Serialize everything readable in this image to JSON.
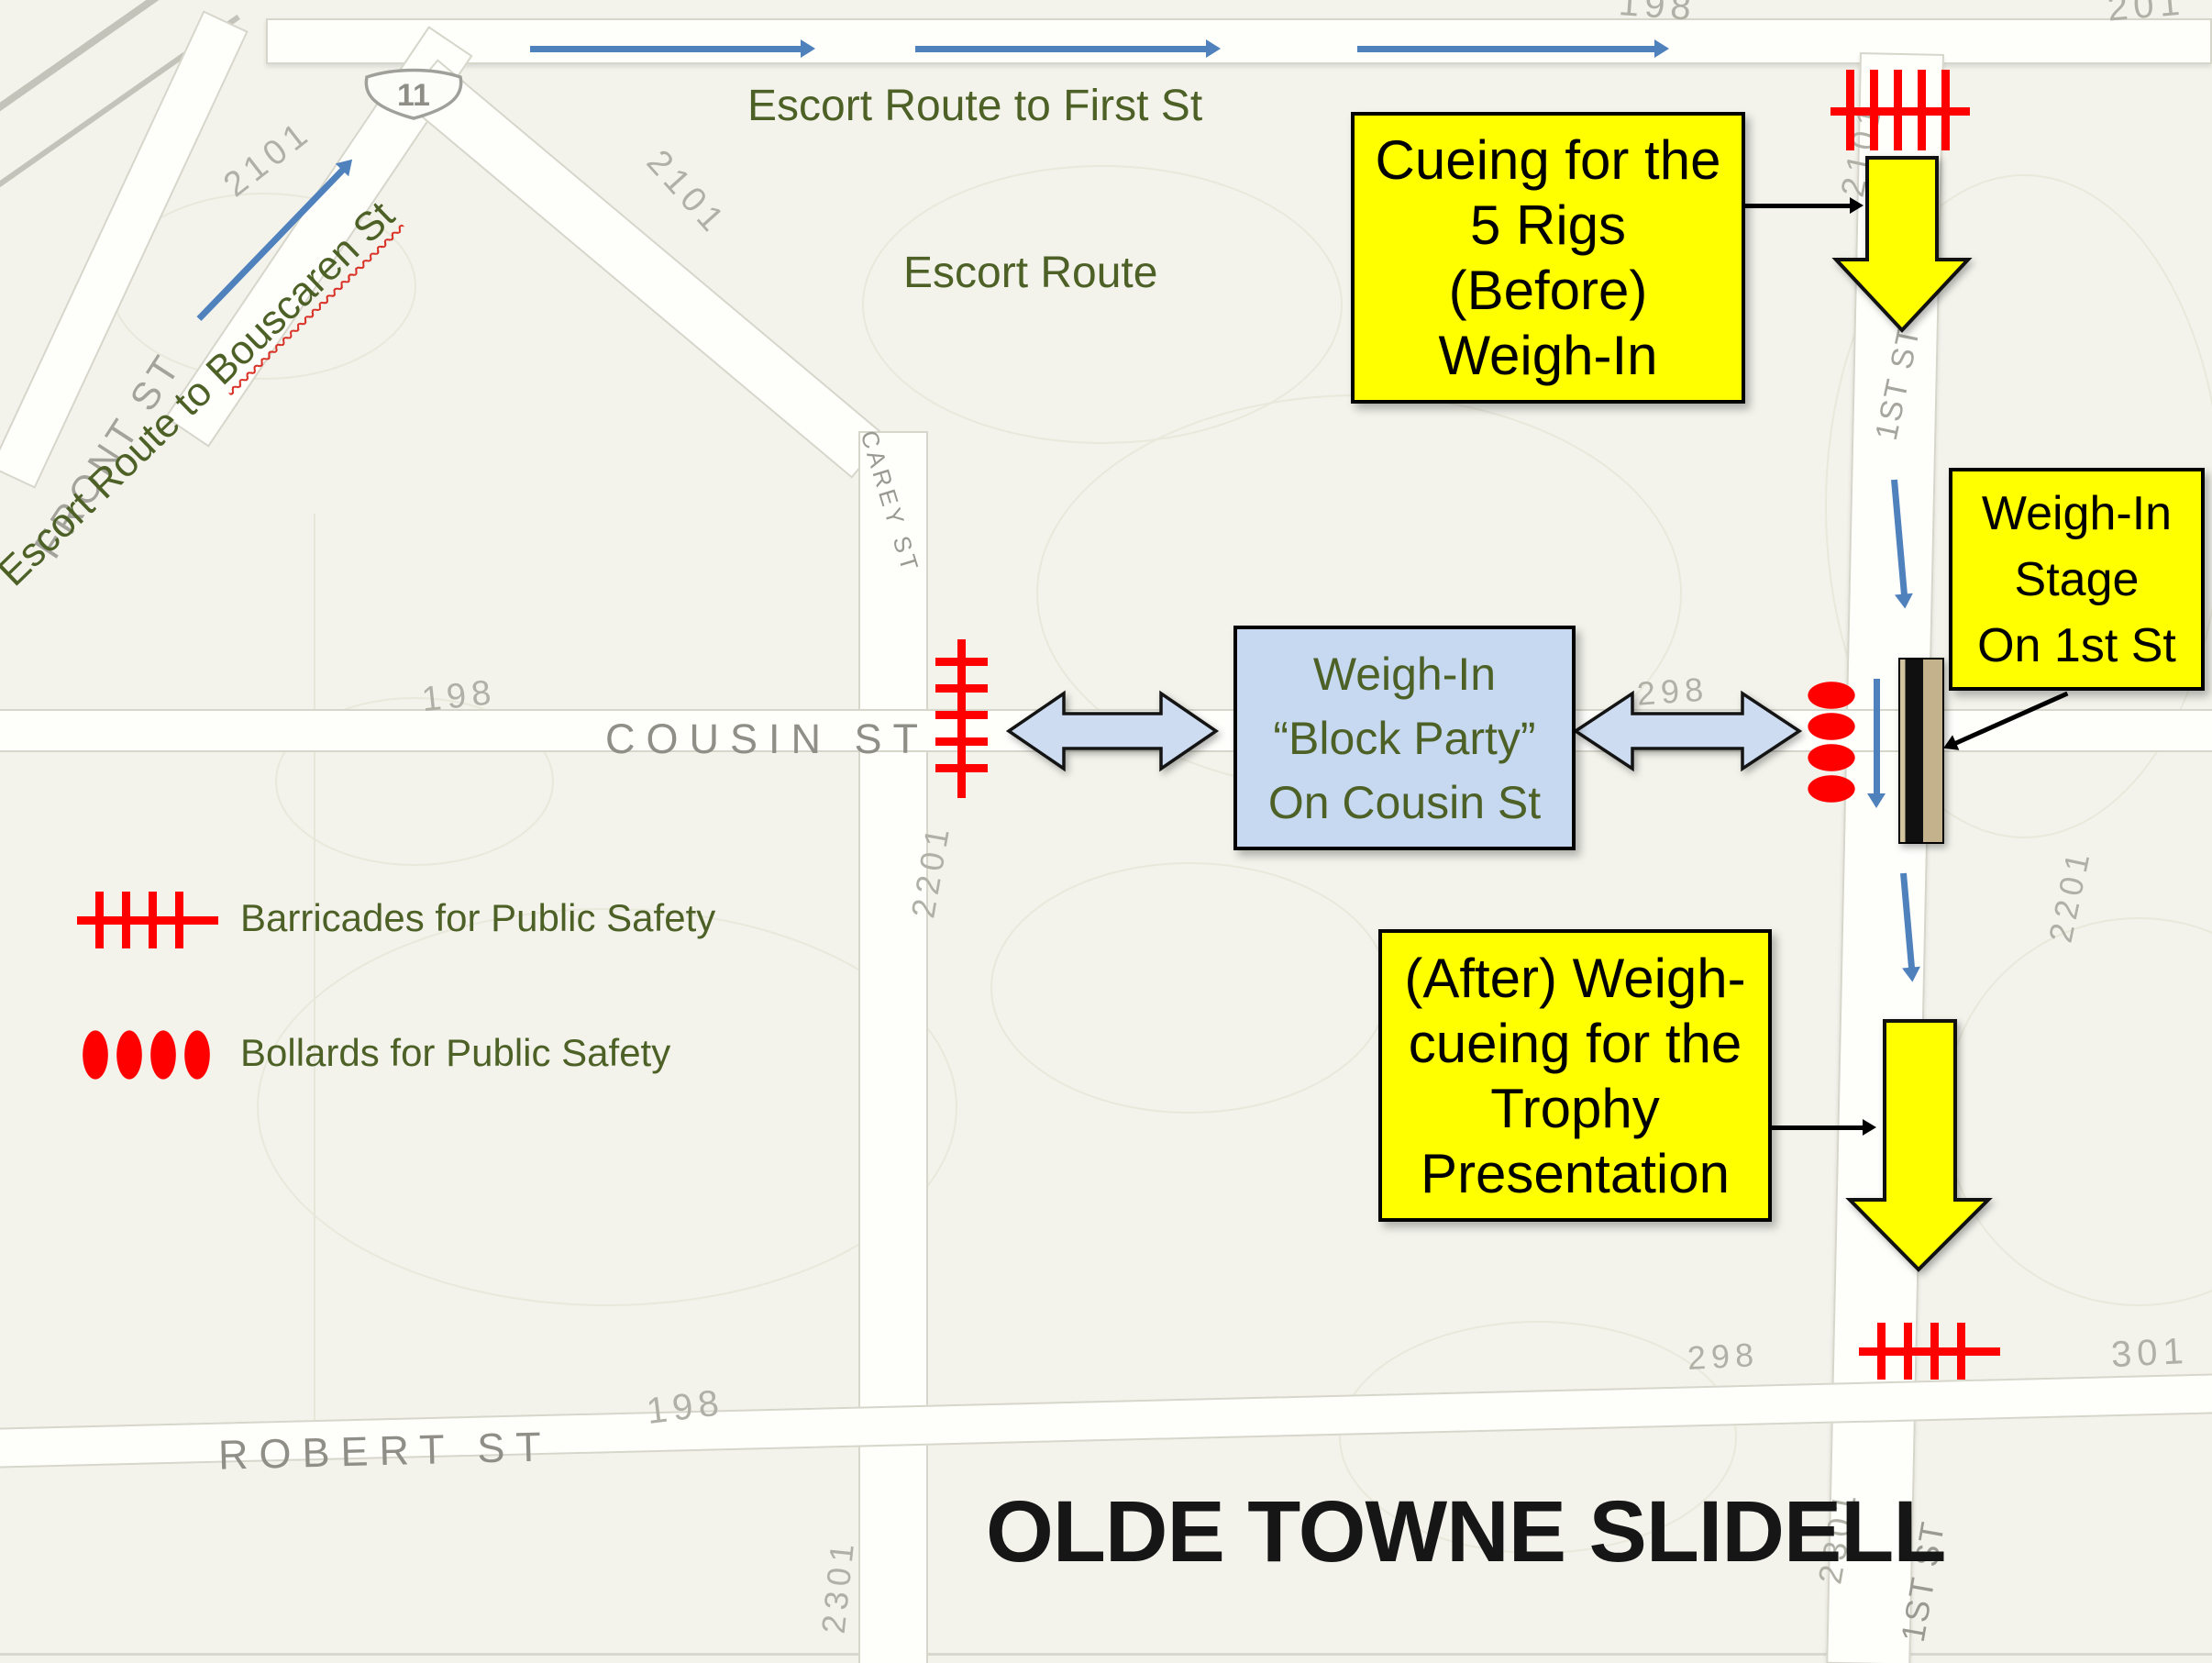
{
  "title": "OLDE TOWNE SLIDELL",
  "colors": {
    "accent_blue": "#4f81bd",
    "callout_yellow": "#ffff00",
    "panel_light_blue": "#c6d9f1",
    "olive_text": "#4d6127",
    "safety_red": "#fe0000",
    "map_label_gray": "#8f8f87"
  },
  "routes": {
    "to_first_st": "Escort Route to First St",
    "escort_route": "Escort Route",
    "to_bouscaren_prefix": "Escort Route to ",
    "to_bouscaren_street": "Bouscaren St"
  },
  "callouts": {
    "cueing_before": "Cueing for the\n5 Rigs\n(Before)\nWeigh-In",
    "weigh_in_stage": "Weigh-In\nStage\nOn 1st St",
    "block_party": "Weigh-In\n“Block Party”\nOn Cousin St",
    "after_trophy": "(After) Weigh-\ncueing for the\nTrophy\nPresentation"
  },
  "legend": {
    "items": [
      {
        "icon": "barricade-icon",
        "label": "Barricades for Public Safety"
      },
      {
        "icon": "bollards-icon",
        "label": "Bollards for Public Safety"
      }
    ]
  },
  "map": {
    "highway_shield": "11",
    "streets": {
      "front": "FRONT ST",
      "cousin": "COUSIN ST",
      "carey": "CAREY ST",
      "robert": "ROBERT ST",
      "first_upper": "1ST ST",
      "first_lower": "1ST ST"
    },
    "blocks": {
      "top_198": "198",
      "top_201": "201",
      "nw_2101": "2101",
      "mid_2101": "2101",
      "first_2101": "2101",
      "cousin_198": "198",
      "cousin_298": "298",
      "carey_2201": "2201",
      "first_2201": "2201",
      "robert_198": "198",
      "robert_298": "298",
      "robert_301": "301",
      "carey_2301": "2301",
      "first_2301": "2301"
    }
  }
}
